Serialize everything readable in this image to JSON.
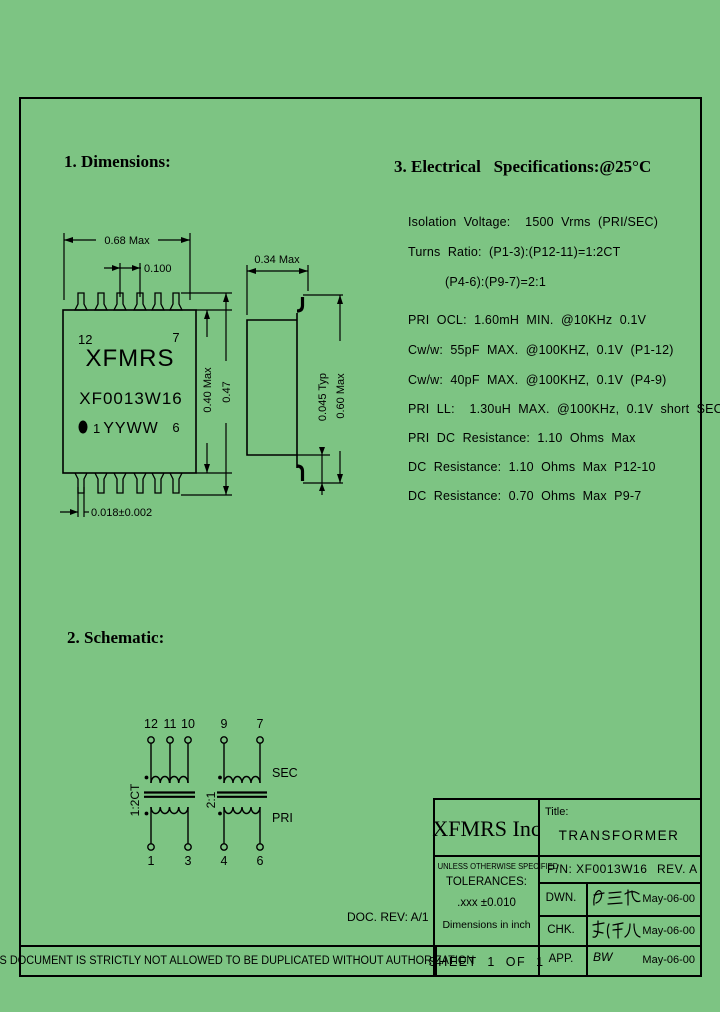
{
  "page": {
    "bg_color": "#7dc483",
    "line_color": "#000000"
  },
  "sections": {
    "dimensions_heading": "1. Dimensions:",
    "schematic_heading": "2. Schematic:",
    "electrical_heading": "3. Electrical   Specifications:@25°C"
  },
  "electrical_specs": [
    "Isolation  Voltage:    1500  Vrms  (PRI/SEC)",
    "Turns  Ratio:  (P1-3):(P12-11)=1:2CT",
    "(P4-6):(P9-7)=2:1",
    "PRI  OCL:  1.60mH  MIN.  @10KHz  0.1V",
    "Cw/w:  55pF  MAX.  @100KHZ,  0.1V  (P1-12)",
    "Cw/w:  40pF  MAX.  @100KHZ,  0.1V  (P4-9)",
    "PRI  LL:    1.30uH  MAX.  @100KHz,  0.1V  short  SEC",
    "PRI  DC  Resistance:  1.10  Ohms  Max",
    "DC  Resistance:  1.10  Ohms  Max  P12-10",
    "DC  Resistance:  0.70  Ohms  Max  P9-7"
  ],
  "front_view": {
    "dim_width": "0.68  Max",
    "dim_pitch": "0.100",
    "dim_body_height": "0.40  Max",
    "dim_overall_height": "0.47",
    "dim_lead": "0.018±0.002",
    "pin_top_left": "12",
    "pin_top_right": "7",
    "pin_bottom_left": "1",
    "pin_bottom_right": "6",
    "brand": "XFMRS",
    "part_number": "XF0013W16",
    "date_code": "YYWW"
  },
  "side_view": {
    "dim_width": "0.34  Max",
    "dim_standoff": "0.045  Typ",
    "dim_height": "0.60  Max"
  },
  "schematic": {
    "top_pins": [
      "12",
      "11",
      "10",
      "9",
      "7"
    ],
    "bottom_pins": [
      "1",
      "3",
      "4",
      "6"
    ],
    "left_ratio": "1:2CT",
    "right_ratio": "2:1",
    "sec_label": "SEC",
    "pri_label": "PRI"
  },
  "doc_rev": "DOC. REV: A/1",
  "footer": {
    "notice": "THIS DOCUMENT IS STRICTLY NOT ALLOWED TO BE DUPLICATED WITHOUT AUTHORIZATION",
    "sheet": "SHEET  1  OF  1"
  },
  "title_block": {
    "company": "XFMRS Inc",
    "title_label": "Title:",
    "title": "TRANSFORMER",
    "pn": "P/N: XF0013W16",
    "rev": "REV. A",
    "tolerances_line1": "UNLESS OTHERWISE SPECIFIED",
    "tolerances_line2": "TOLERANCES:",
    "tolerances_line3": ".xxx ±0.010",
    "tolerances_line4": "Dimensions in inch",
    "rows": [
      {
        "label": "DWN.",
        "signature": "蔡三神",
        "date": "May-06-00"
      },
      {
        "label": "CHK.",
        "signature": "李清儿",
        "date": "May-06-00"
      },
      {
        "label": "APP.",
        "signature": "BW",
        "date": "May-06-00"
      }
    ]
  }
}
